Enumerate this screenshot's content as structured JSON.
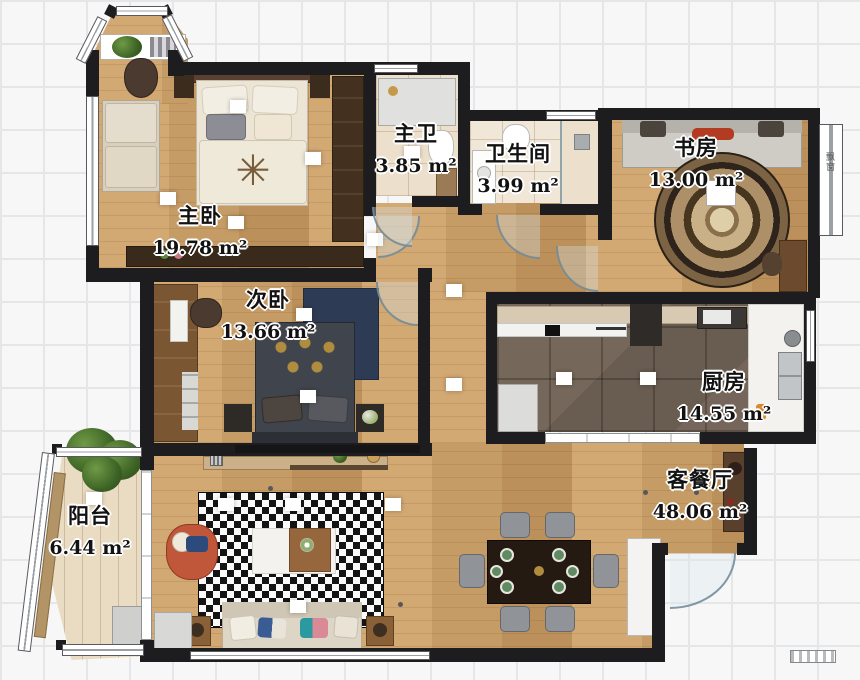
{
  "plan": {
    "rooms": [
      {
        "id": "master-bedroom",
        "label": "主卧",
        "area": "19.78 m²"
      },
      {
        "id": "second-bedroom",
        "label": "次卧",
        "area": "13.66 m²"
      },
      {
        "id": "master-bath",
        "label": "主卫",
        "area": "3.85 m²"
      },
      {
        "id": "bathroom",
        "label": "卫生间",
        "area": "3.99 m²"
      },
      {
        "id": "study",
        "label": "书房",
        "area": "13.00 m²"
      },
      {
        "id": "kitchen",
        "label": "厨房",
        "area": "14.55 m²"
      },
      {
        "id": "living-dining",
        "label": "客餐厅",
        "area": "48.06 m²"
      },
      {
        "id": "balcony",
        "label": "阳台",
        "area": "6.44 m²"
      }
    ],
    "annotations": {
      "bay_window": "飘窗"
    },
    "colors": {
      "wall": "#1d1d20",
      "wood_floor": "#c9a06b",
      "kitchen_tile": "#6d6057",
      "bath_tile": "#ecdfcc",
      "rug_pattern_dark": "#141414",
      "accent_chair": "#c0563a",
      "dark_bed": "#40444c",
      "grid_line": "#e5e6e8"
    }
  }
}
